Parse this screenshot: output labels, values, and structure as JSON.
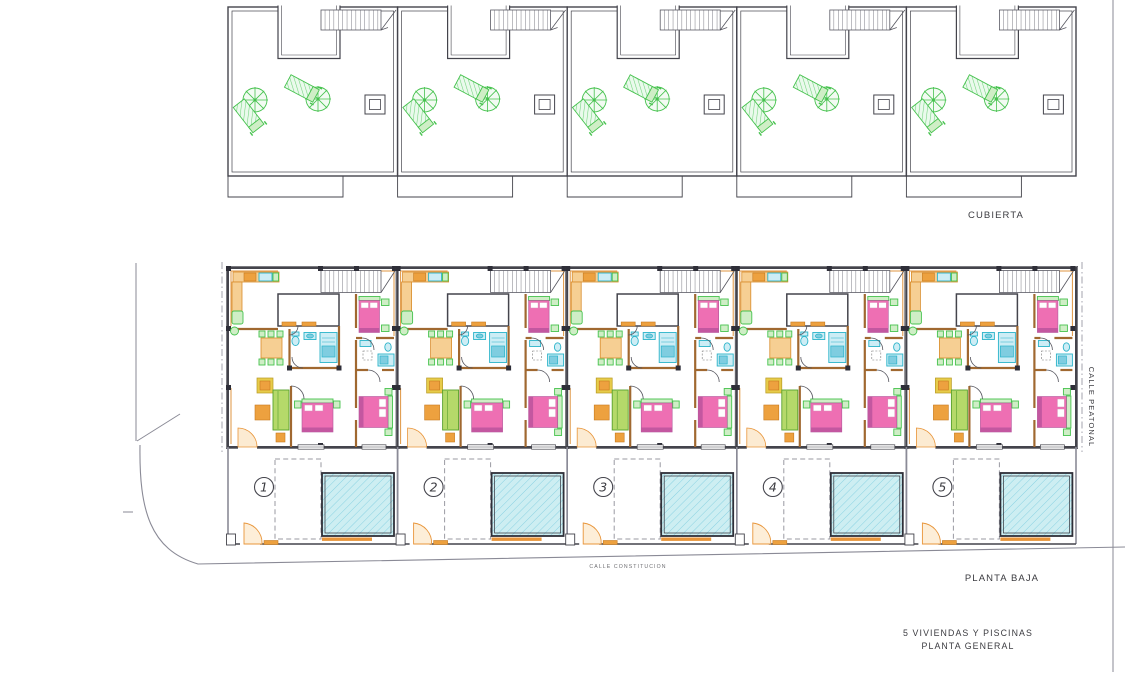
{
  "drawing": {
    "roof_label": "CUBIERTA",
    "ground_label": "PLANTA BAJA",
    "title_line1": "5 VIVIENDAS Y PISCINAS",
    "title_line2": "PLANTA GENERAL",
    "street_right_label": "CALLE PEATONAL",
    "street_bottom_label": "CALLE CONSTITUCION",
    "unit_count": 5
  },
  "units": [
    {
      "number": "1"
    },
    {
      "number": "2"
    },
    {
      "number": "3"
    },
    {
      "number": "4"
    },
    {
      "number": "5"
    }
  ],
  "colors": {
    "wall_dark": "#44444c",
    "wood_orange": "#a06830",
    "counter_orange": "#d98c2b",
    "bed_pink": "#ee6fb3",
    "plant_green": "#46c24e",
    "fixture_cyan": "#2ab3c9",
    "pool_blue": "#cdeef2",
    "street_gray": "#8a8a96"
  }
}
